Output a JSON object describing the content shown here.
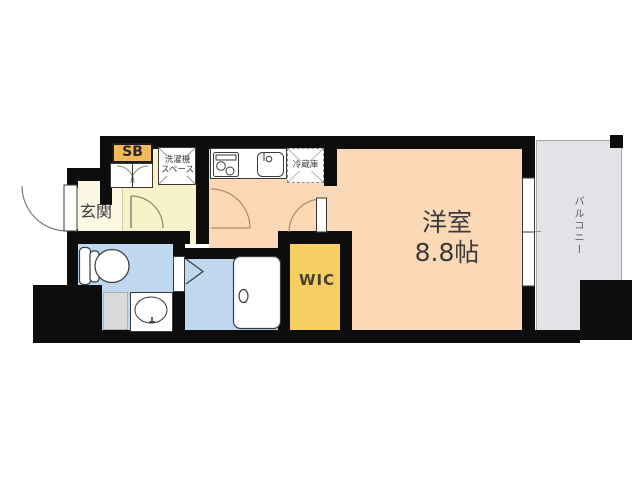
{
  "floorplan": {
    "rooms": {
      "main_room": {
        "name": "洋室",
        "size": "8.8帖"
      },
      "entrance": {
        "label": "玄関"
      },
      "shoe_box": {
        "label": "SB"
      },
      "laundry_space": {
        "label_line1": "洗濯機",
        "label_line2": "スペース"
      },
      "refrigerator": {
        "label": "冷蔵庫"
      },
      "walk_in_closet": {
        "label": "WIC"
      },
      "balcony": {
        "label": "バルコニー"
      }
    },
    "colors": {
      "wall": "#0d0d0d",
      "main_room_fill": "#fbd9b7",
      "hallway_fill": "#f8f2c9",
      "genkan_fill": "#fbf7e2",
      "wet_area_fill": "#bfd8f0",
      "wic_fill": "#f6cf63",
      "shoe_box_fill": "#f2ba59",
      "balcony_fill": "#e3e2e6"
    }
  }
}
